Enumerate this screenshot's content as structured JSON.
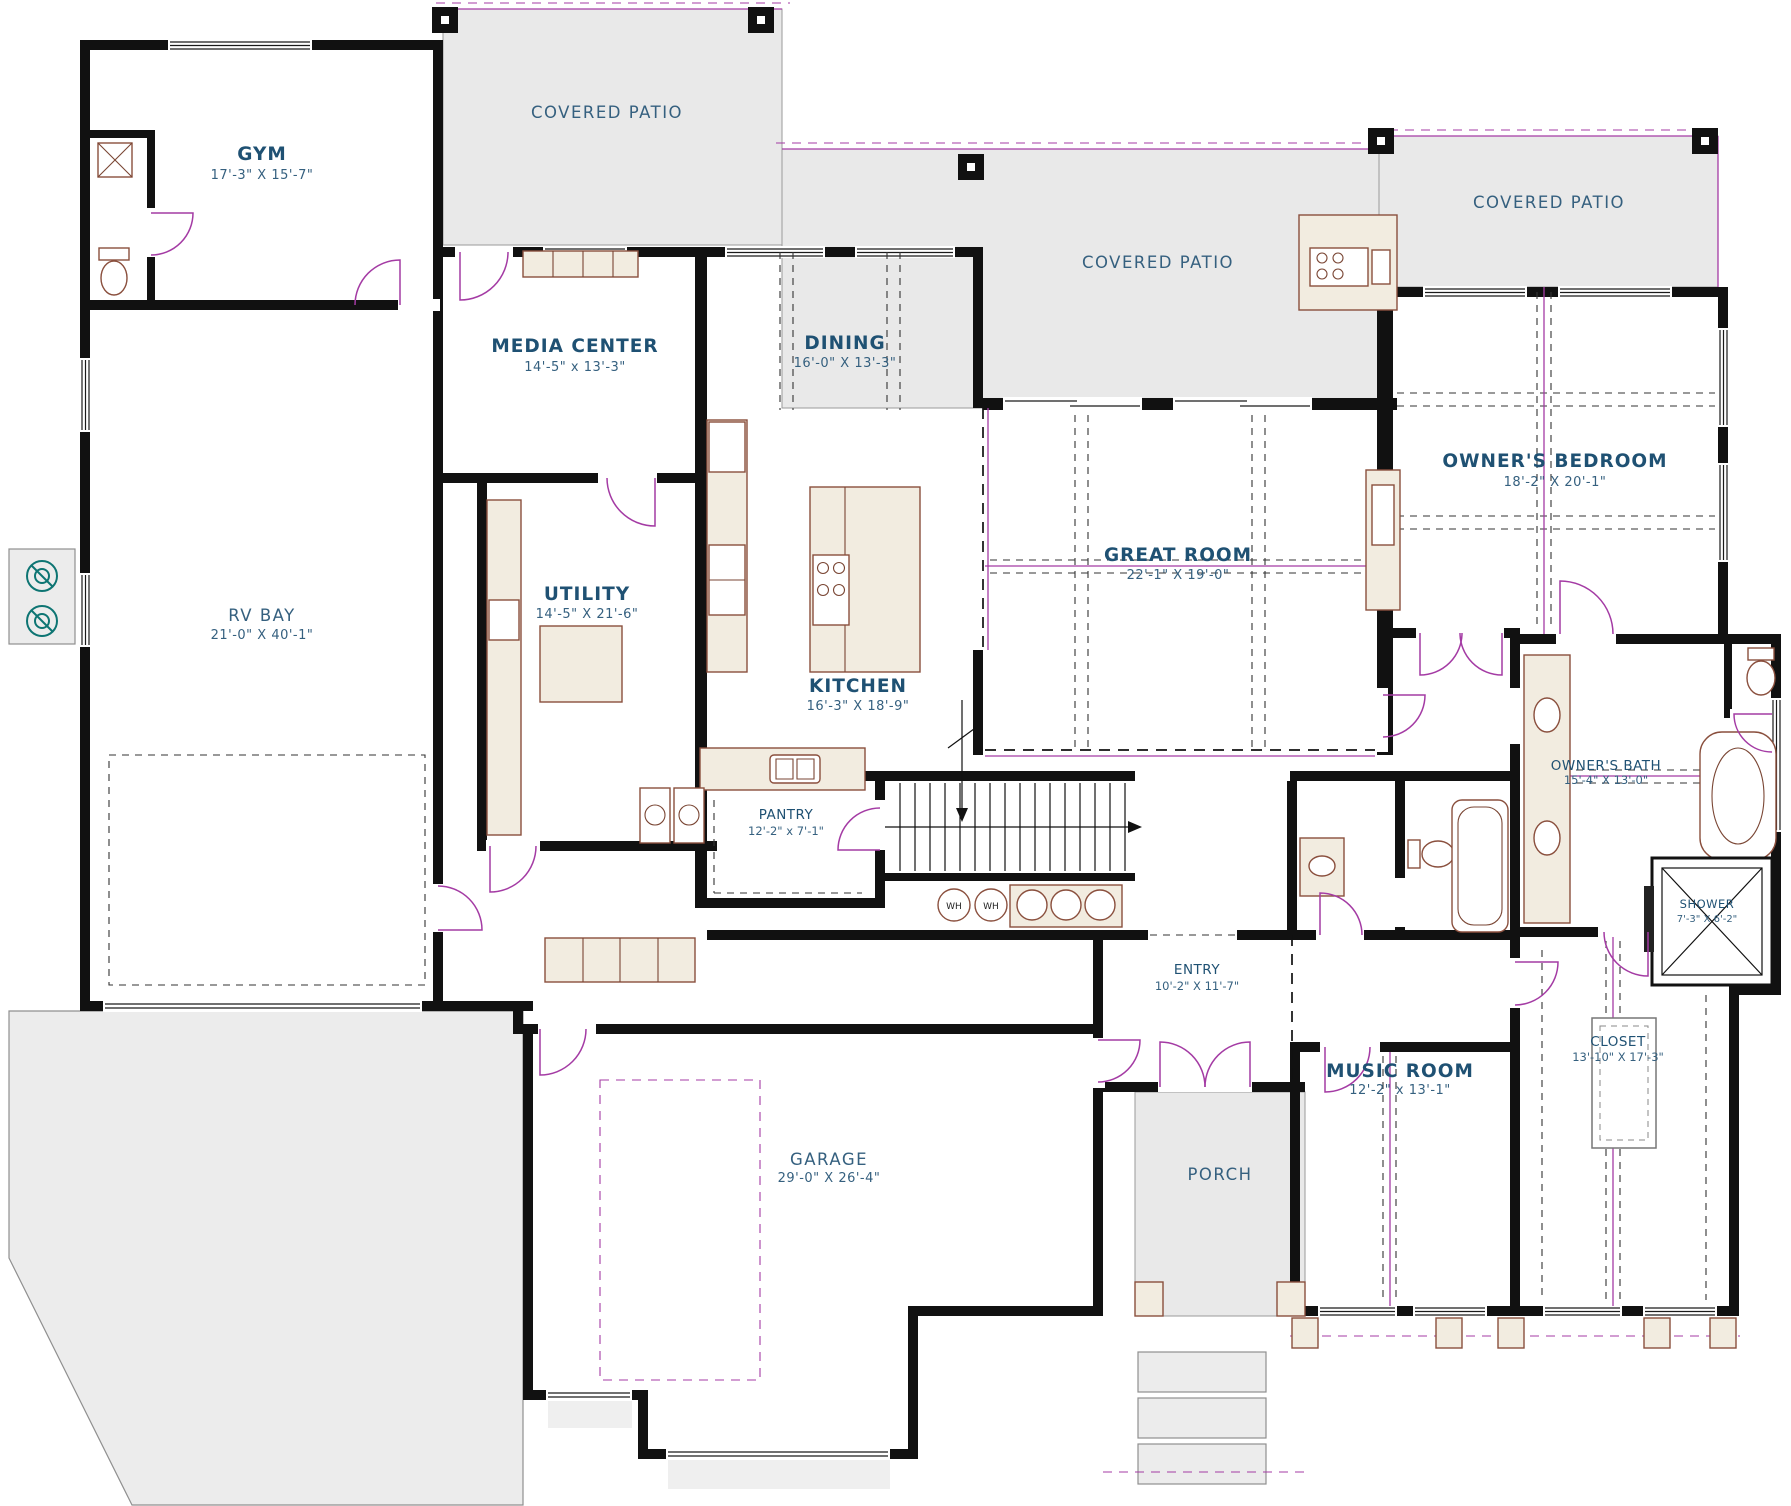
{
  "plan": {
    "rooms": {
      "gym": {
        "label": "GYM",
        "dims": "17'-3\" X 15'-7\""
      },
      "media_center": {
        "label": "MEDIA CENTER",
        "dims": "14'-5\" x 13'-3\""
      },
      "dining": {
        "label": "DINING",
        "dims": "16'-0\" X 13'-3\""
      },
      "owners_bedroom": {
        "label": "OWNER'S BEDROOM",
        "dims": "18'-2\" X 20'-1\""
      },
      "rv_bay": {
        "label": "RV BAY",
        "dims": "21'-0\" X 40'-1\""
      },
      "utility": {
        "label": "UTILITY",
        "dims": "14'-5\" X 21'-6\""
      },
      "great_room": {
        "label": "GREAT ROOM",
        "dims": "22'-1\" X 19'-0\""
      },
      "kitchen": {
        "label": "KITCHEN",
        "dims": "16'-3\" X 18'-9\""
      },
      "pantry": {
        "label": "PANTRY",
        "dims": "12'-2\" x 7'-1\""
      },
      "entry": {
        "label": "ENTRY",
        "dims": "10'-2\" X 11'-7\""
      },
      "music_room": {
        "label": "MUSIC ROOM",
        "dims": "12'-2\" x 13'-1\""
      },
      "closet": {
        "label": "CLOSET",
        "dims": "13'-10\" X 17'-3\""
      },
      "owners_bath": {
        "label": "OWNER'S BATH",
        "dims": "15'-4\" X 13'-0\""
      },
      "shower": {
        "label": "SHOWER",
        "dims": "7'-3\" X 6'-2\""
      },
      "garage": {
        "label": "GARAGE",
        "dims": "29'-0\" X 26'-4\""
      },
      "porch": {
        "label": "PORCH"
      }
    },
    "patios": {
      "top": {
        "label": "COVERED PATIO"
      },
      "middle": {
        "label": "COVERED PATIO"
      },
      "right": {
        "label": "COVERED PATIO"
      }
    },
    "fixtures": {
      "water_heater_1": "WH",
      "water_heater_2": "WH"
    },
    "colors": {
      "wall": "#111111",
      "label": "#1f5173",
      "dims": "#35607f",
      "patio_fill": "#e9e9e9",
      "door": "#a43ba4",
      "fixture_line": "#8a4f3d",
      "fixture_fill": "#f2ece0",
      "teal": "#0e7573"
    }
  }
}
